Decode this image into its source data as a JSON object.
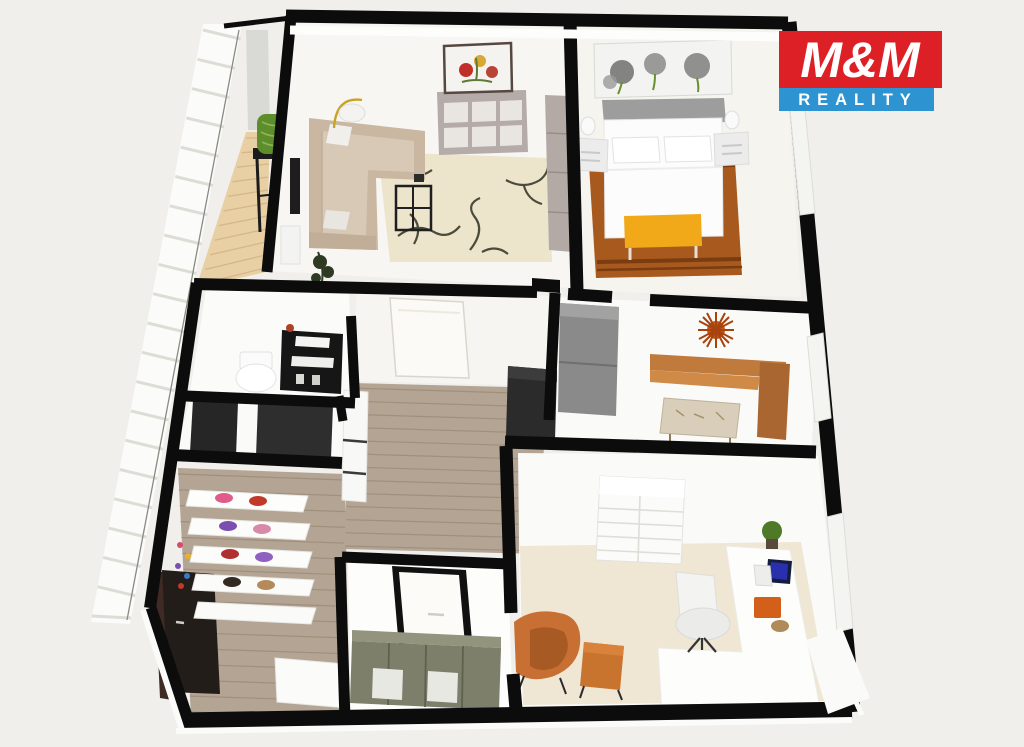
{
  "app": {
    "type": "3d-floor-plan-render",
    "description": "Isometric 3D floor plan rendering of an apartment, brand-marked real estate visual"
  },
  "logo": {
    "line1": "M&M",
    "line2": "REALITY"
  },
  "palette": {
    "bg": "#f0efeb",
    "wall": "#0c0c0c",
    "room_floor": "#f7f6f3",
    "wood": "#b3a494",
    "wood_line": "#a08f7a",
    "deck": "#e8d0a4",
    "deck_line": "#d2b78b",
    "railing": "#fbfbf9",
    "railing_slat": "#dddcd5",
    "sofa": "#c9b7a2",
    "sofa_light": "#d8c9b6",
    "rug_living": "#ece4cb",
    "branch": "#4a4b3a",
    "sideboard": "#b5acaa",
    "wardrobe": "#b3aaa6",
    "bed_white": "#fcfcfc",
    "headboard": "#9d9d9d",
    "rug_bed": "#a85a1e",
    "rug_bed_dark": "#7a3c10",
    "bench_yellow": "#f2a919",
    "nightstand": "#ececec",
    "fridge": "#8a8a8a",
    "dark_unit": "#2b2b2b",
    "kitchen_bench": "#c07a3c",
    "kitchen_bench_dark": "#a96630",
    "starburst": "#a8430e",
    "rug_office": "#efe6d3",
    "armchair": "#c86f34",
    "ottoman": "#c8732e",
    "olive_cabinet": "#7d7f6a",
    "olive_top": "#92947e",
    "dark_door": "#231d1a",
    "chair_green": "#5e8e2c",
    "plant_green": "#4e7a28",
    "laptop_screen": "#2a2fae",
    "desk_mat": "#d2601a",
    "logo_red": "#dd2026",
    "logo_blue": "#2d93d1",
    "logo_text": "#ffffff"
  },
  "rooms": [
    {
      "id": "balcony",
      "furniture": [
        "green-designer-chair",
        "dark-side-table",
        "wood-deck",
        "railing"
      ]
    },
    {
      "id": "living-room",
      "furniture": [
        "corner-sofa",
        "floor-lamp",
        "coffee-table",
        "area-rug-branch-pattern",
        "sideboard",
        "flower-painting",
        "tall-wardrobe",
        "wall-tv",
        "plant",
        "radiator"
      ]
    },
    {
      "id": "bedroom",
      "furniture": [
        "double-bed",
        "headboard",
        "pillows",
        "nightstand-left",
        "nightstand-right",
        "table-lamps",
        "foot-bench-yellow",
        "rust-rug",
        "dandelion-artwork"
      ]
    },
    {
      "id": "toilet-room",
      "furniture": [
        "toilet",
        "black-storage-cart"
      ]
    },
    {
      "id": "utility-niche",
      "furniture": [
        "dark-appliance-left",
        "dark-appliance-right"
      ]
    },
    {
      "id": "hallway",
      "furniture": [
        "white-cabinet",
        "open-door-leaf",
        "dark-wardrobe-unit",
        "wood-floor"
      ]
    },
    {
      "id": "kitchen",
      "furniture": [
        "fridge",
        "corner-dining-bench",
        "dining-table",
        "starburst-wall-decor"
      ]
    },
    {
      "id": "entry-closet",
      "furniture": [
        "shoe-shelves",
        "shoes-colorful",
        "dark-entrance-door",
        "white-counter",
        "wood-floor"
      ]
    },
    {
      "id": "entry-nook",
      "furniture": [
        "front-door-white",
        "olive-sideboard"
      ]
    },
    {
      "id": "office-room",
      "furniture": [
        "white-shelving-unit",
        "l-shaped-desk",
        "laptop",
        "desk-mat-orange",
        "desk-plant",
        "office-chair-white",
        "armchair-orange",
        "ottoman-orange",
        "cream-rug",
        "windows"
      ]
    }
  ]
}
